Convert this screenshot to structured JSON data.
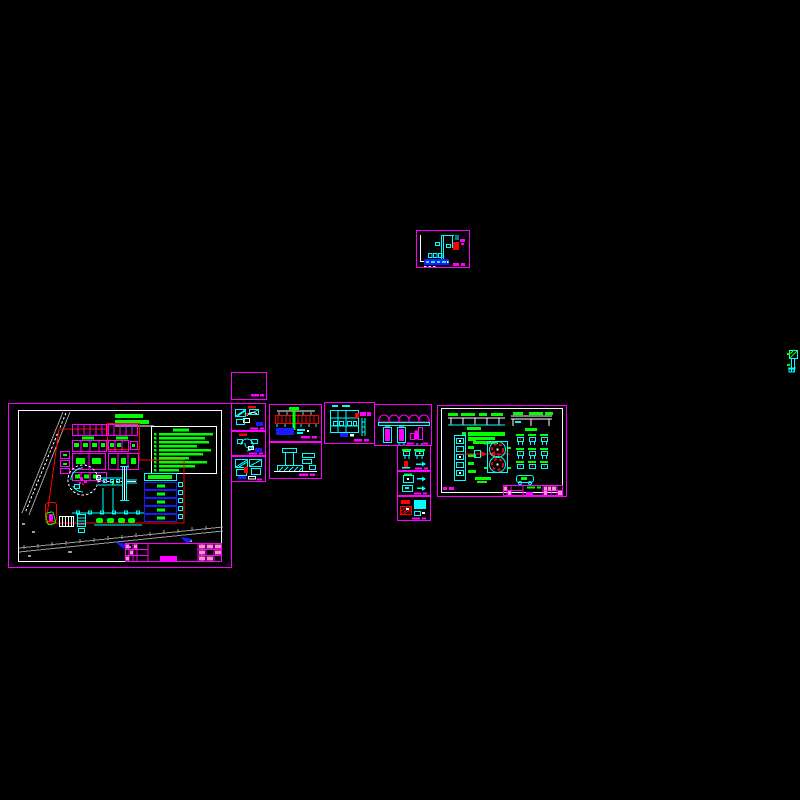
{
  "canvas": {
    "width": 800,
    "height": 800,
    "background": "#000000",
    "kind": "CAD model space overview, black background"
  },
  "palette": {
    "magenta": "#ff00ff",
    "cyan": "#00ffff",
    "green": "#00ff00",
    "red": "#ff0000",
    "blue": "#1a1aff",
    "white": "#ffffff",
    "gray": "#9c9c9c",
    "pink": "#ff8ad2",
    "bg": "#000000"
  },
  "sheets": [
    {
      "id": "site-plan",
      "frame_color": "magenta",
      "inner_frame": "white",
      "features": {
        "service_bays": 5,
        "legend_lines": 10,
        "building_rows": 4,
        "flow_arrows": 2,
        "roads": 2,
        "station_circle": 1,
        "canopy": 1,
        "title_block_cells": "pink/magenta grid"
      }
    },
    {
      "id": "pump-room-detail",
      "frame_color": "magenta",
      "features": {
        "red_equipment_block": 1,
        "blue_schedule_bar": 1,
        "cyan_walls": true
      }
    },
    {
      "id": "blank-frame",
      "frame_color": "magenta",
      "features": {
        "title_stub": 2
      }
    },
    {
      "id": "detail-a",
      "frame_color": "magenta",
      "features": {
        "hatched_plan": true,
        "red_label": 1,
        "blue_block": 1
      }
    },
    {
      "id": "detail-b",
      "frame_color": "magenta",
      "features": {
        "curved_detail": true,
        "red_label": 1,
        "blue_block": 1
      }
    },
    {
      "id": "detail-c",
      "frame_color": "magenta",
      "features": {
        "hatched_plan": true,
        "red_figure": 1
      }
    },
    {
      "id": "section-detail",
      "frame_color": "magenta",
      "features": {
        "red_hatched_beam": 1,
        "green_column": 1,
        "blue_table": 1
      }
    },
    {
      "id": "foundation-section",
      "frame_color": "magenta",
      "features": {
        "t_shaped_footing": 1,
        "steps": 2
      }
    },
    {
      "id": "piping-plan",
      "frame_color": "magenta",
      "features": {
        "red_block": 1,
        "magenta_blocks": 2,
        "fixture_row": 4
      }
    },
    {
      "id": "tank-elevation",
      "frame_color": "magenta",
      "features": {
        "arches": 5,
        "tanks": 2,
        "stepped_block": 3
      }
    },
    {
      "id": "fixtures-a",
      "frame_color": "magenta",
      "features": {
        "fixtures": 2,
        "red_element": 1,
        "arrow": 1
      }
    },
    {
      "id": "fixtures-b",
      "frame_color": "magenta",
      "features": {
        "fixtures": 2,
        "arrows": 2
      }
    },
    {
      "id": "fixtures-c",
      "frame_color": "magenta",
      "features": {
        "red_block": 1,
        "cyan_block": 1,
        "red_hatch_block": 1
      }
    },
    {
      "id": "dispenser-detail",
      "frame_color": "magenta",
      "inner_frame": "white",
      "features": {
        "elevations": 2,
        "island_circles": 2,
        "rack_boxes": 5,
        "fixture_grid_rows": 3,
        "fixture_grid_cols": 3,
        "car": 1,
        "red_centerline": 1,
        "title_block_cells": "pink/magenta grid"
      }
    },
    {
      "id": "edge-fragment",
      "features": {
        "cyan_riser": 1,
        "green_ticks": 2
      }
    }
  ]
}
